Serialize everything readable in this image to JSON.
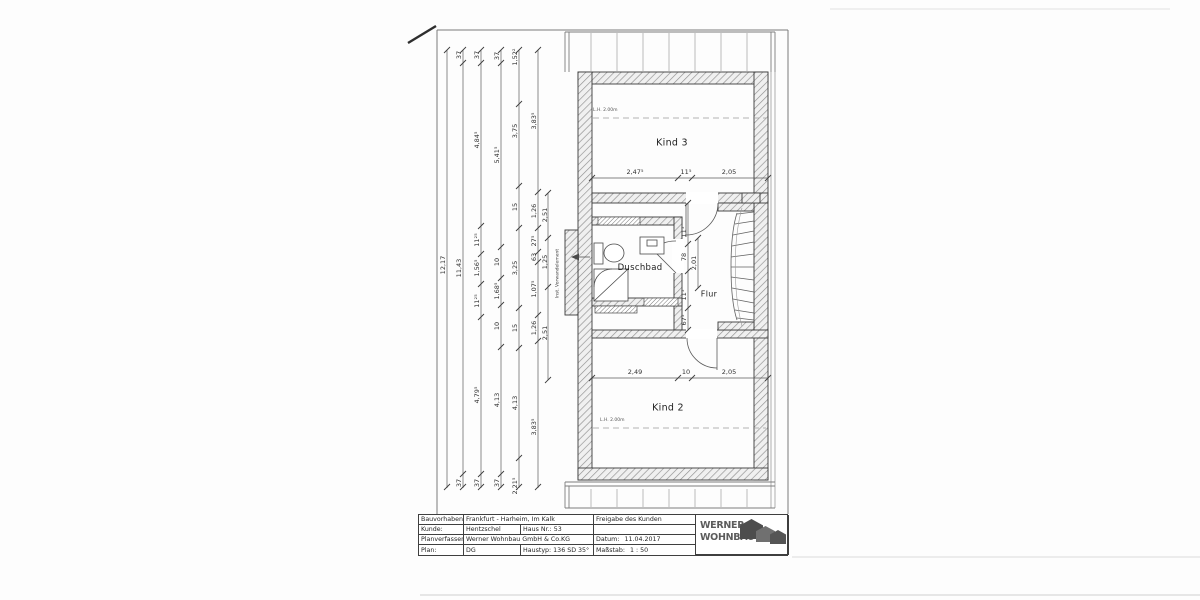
{
  "rooms": {
    "kind3": "Kind 3",
    "duschbad": "Duschbad",
    "flur": "Flur",
    "kind2": "Kind 2"
  },
  "annotations": {
    "lh_kind3": "L.H. 2.00m",
    "lh_kind2": "L.H. 2.00m",
    "vorwand": "Inst. Vorwandelement"
  },
  "dims": {
    "total": "12,17",
    "chain2": [
      "37",
      "11,43",
      "37"
    ],
    "chain3": [
      "37",
      "4,84⁵",
      "11²⁵",
      "1,56⁵",
      "11²⁵",
      "4,79⁵",
      "37"
    ],
    "chain4": [
      "37",
      "5,41⁵",
      "10",
      "1,68⁵",
      "10",
      "4,13",
      "37"
    ],
    "chain5": [
      "1,52²",
      "3,75",
      "15",
      "3,25",
      "15",
      "4,13",
      "2,21⁵"
    ],
    "chain6": [
      "3,83⁵",
      "1,26",
      "27⁵",
      "63",
      "1,07⁵",
      "1,26",
      "3,83⁵"
    ],
    "chain7": [
      "2,51",
      "1,25",
      "2,51"
    ],
    "kind3_width": [
      "2,47⁵",
      "11⁵",
      "2,05"
    ],
    "kind2_width": [
      "2,49",
      "10",
      "2,05"
    ],
    "flur": [
      "11⁵",
      "78",
      "11⁵",
      "67⁵"
    ],
    "flur_total": "2,01"
  },
  "title_block": {
    "bauvorhaben_label": "Bauvorhaben:",
    "bauvorhaben": "Frankfurt - Harheim, Im Kalk",
    "kunde_label": "Kunde:",
    "kunde": "Hentzschel",
    "haus_nr": "Haus Nr.: 53",
    "planverfasser_label": "Planverfasser:",
    "planverfasser": "Werner Wohnbau GmbH & Co.KG",
    "plan_label": "Plan:",
    "plan": "DG",
    "haustyp": "Haustyp: 136 SD 35°",
    "freigabe": "Freigabe des Kunden",
    "datum_label": "Datum:",
    "datum": "11.04.2017",
    "massstab_label": "Maßstab:",
    "massstab": "1 : 50",
    "logo_line1": "WERNER",
    "logo_line2": "WOHNBAU"
  },
  "colors": {
    "ink": "#3a3a3a",
    "logo_gray": "#5c5c5c"
  }
}
